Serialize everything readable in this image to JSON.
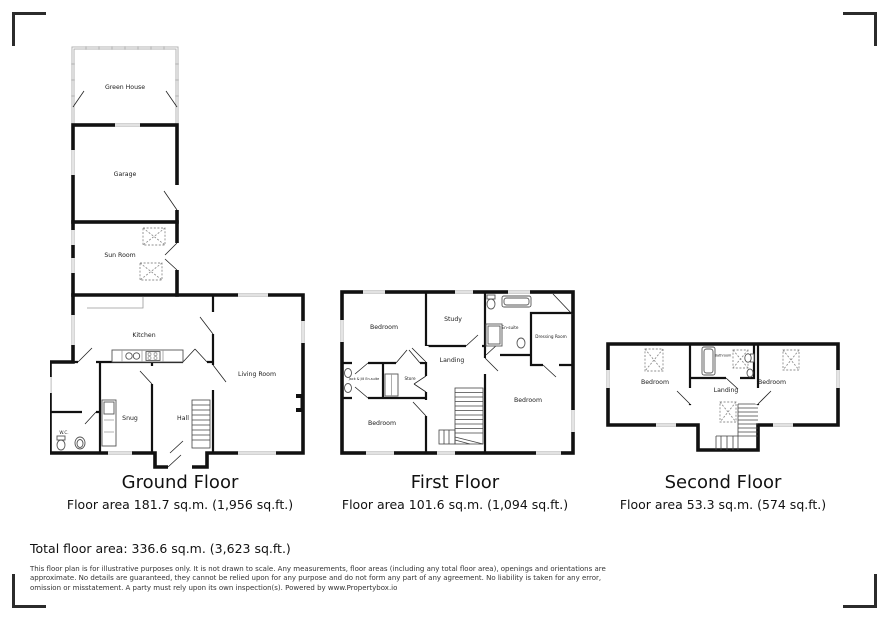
{
  "floors": {
    "ground": {
      "title": "Ground Floor",
      "area": "Floor area 181.7 sq.m. (1,956 sq.ft.)",
      "rooms": {
        "green_house": "Green House",
        "garage": "Garage",
        "sun_room": "Sun Room",
        "kitchen": "Kitchen",
        "living_room": "Living Room",
        "snug": "Snug",
        "hall": "Hall",
        "wc": "W.C."
      }
    },
    "first": {
      "title": "First Floor",
      "area": "Floor area 101.6 sq.m. (1,094 sq.ft.)",
      "rooms": {
        "bedroom_top_left": "Bedroom",
        "study": "Study",
        "en_suite": "En-suite",
        "dressing_room": "Dressing Room",
        "jack_jill_en_suite": "Jack & Jill En-suite",
        "store": "Store",
        "landing": "Landing",
        "bedroom_bottom_left": "Bedroom",
        "bedroom_right": "Bedroom"
      }
    },
    "second": {
      "title": "Second Floor",
      "area": "Floor area 53.3 sq.m. (574 sq.ft.)",
      "rooms": {
        "bedroom_left": "Bedroom",
        "bathroom": "Bathroom",
        "landing": "Landing",
        "bedroom_right": "Bedroom"
      }
    }
  },
  "summary": {
    "total": "Total floor area: 336.6 sq.m. (3,623 sq.ft.)"
  },
  "disclaimer": {
    "line1": "This floor plan is for illustrative purposes only. It is not drawn to scale. Any measurements, floor areas (including any total floor area), openings and orientations are",
    "line2": "approximate. No details are guaranteed, they cannot be relied upon for any purpose and do not form any part of any agreement. No liability is taken for any error,",
    "line3": "omission or misstatement. A party must rely upon its own inspection(s). Powered by www.Propertybox.io"
  },
  "colors": {
    "wall": "#111111",
    "window": "#c4c4c4",
    "greenhouse_wall": "#b0b0b0",
    "corner_mark": "#2b2b2b"
  }
}
